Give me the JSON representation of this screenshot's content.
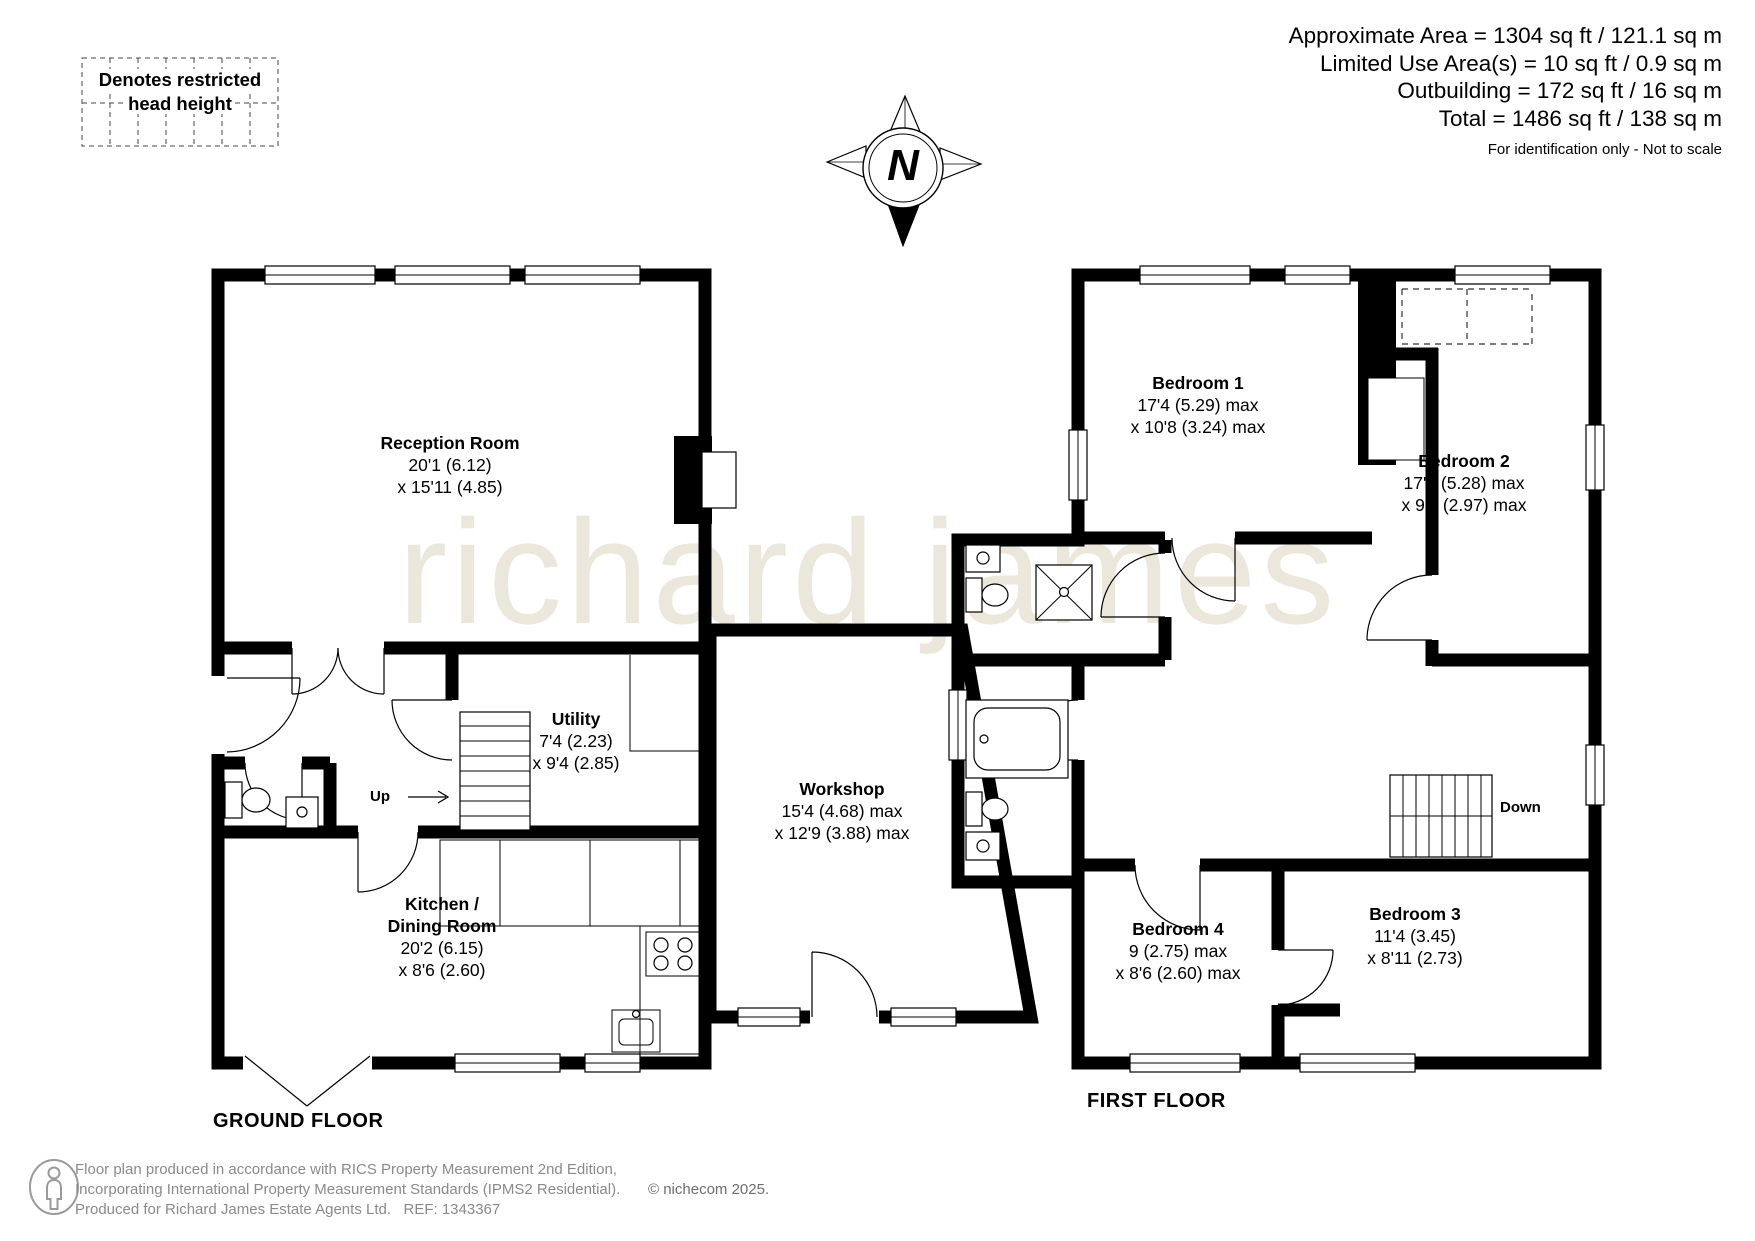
{
  "header": {
    "lines": [
      "Approximate Area = 1304 sq ft / 121.1 sq m",
      "Limited Use Area(s) = 10 sq ft / 0.9 sq m",
      "Outbuilding = 172 sq ft / 16 sq m",
      "Total = 1486 sq ft / 138 sq m"
    ],
    "disclaimer": "For identification only - Not to scale"
  },
  "legend": {
    "line1": "Denotes restricted",
    "line2": "head height"
  },
  "compass": {
    "label": "N"
  },
  "watermark": {
    "text": "richard james"
  },
  "floors": {
    "ground": {
      "title": "GROUND FLOOR",
      "stair_label": "Up",
      "rooms": {
        "reception": {
          "name": "Reception Room",
          "dims": [
            "20'1 (6.12)",
            "x 15'11 (4.85)"
          ]
        },
        "utility": {
          "name": "Utility",
          "dims": [
            "7'4 (2.23)",
            "x 9'4 (2.85)"
          ]
        },
        "kitchen": {
          "name1": "Kitchen /",
          "name2": "Dining Room",
          "dims": [
            "20'2 (6.15)",
            "x 8'6 (2.60)"
          ]
        },
        "workshop": {
          "name": "Workshop",
          "dims": [
            "15'4 (4.68) max",
            "x 12'9 (3.88) max"
          ]
        }
      }
    },
    "first": {
      "title": "FIRST FLOOR",
      "stair_label": "Down",
      "rooms": {
        "bedroom1": {
          "name": "Bedroom 1",
          "dims": [
            "17'4 (5.29) max",
            "x 10'8 (3.24) max"
          ]
        },
        "bedroom2": {
          "name": "Bedroom 2",
          "dims": [
            "17'4 (5.28) max",
            "x 9'5 (2.97) max"
          ]
        },
        "bedroom3": {
          "name": "Bedroom 3",
          "dims": [
            "11'4 (3.45)",
            "x 8'11 (2.73)"
          ]
        },
        "bedroom4": {
          "name": "Bedroom 4",
          "dims": [
            "9 (2.75) max",
            "x 8'6 (2.60) max"
          ]
        }
      }
    }
  },
  "footer": {
    "line1": "Floor plan produced in accordance with RICS Property Measurement 2nd Edition,",
    "line2": "Incorporating International Property Measurement Standards (IPMS2 Residential).",
    "copyright": "© nichecom 2025.",
    "line3": "Produced for Richard James Estate Agents Ltd.   REF: 1343367"
  },
  "colors": {
    "wall": "#000000",
    "watermark": "#ece7db",
    "footer_text": "#8a8a8a"
  }
}
